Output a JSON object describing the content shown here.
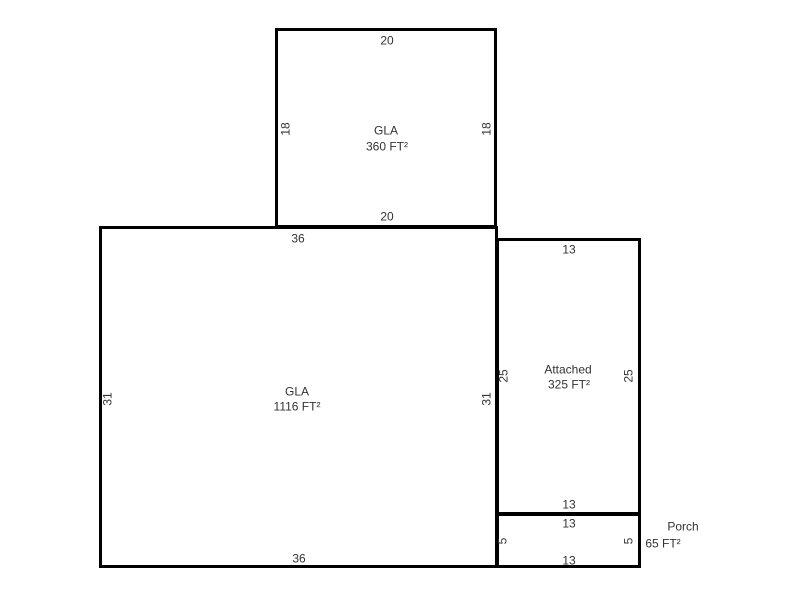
{
  "sketch": {
    "background": "#ffffff",
    "wall_color": "#000000",
    "text_color": "#333333",
    "areas": [
      {
        "id": "gla-upper",
        "name": "GLA",
        "area_text": "360 FT²",
        "rect": {
          "left": 275,
          "top": 28,
          "width": 222,
          "height": 200
        },
        "labels": [
          {
            "role": "name",
            "text": "GLA",
            "x": 386,
            "y": 131
          },
          {
            "role": "area",
            "text": "360 FT²",
            "x": 387,
            "y": 147
          }
        ],
        "dims": [
          {
            "side": "top",
            "text": "20",
            "x": 387,
            "y": 41
          },
          {
            "side": "left",
            "text": "18",
            "x": 286,
            "y": 129
          },
          {
            "side": "right",
            "text": "18",
            "x": 487,
            "y": 129
          },
          {
            "side": "bottom",
            "text": "20",
            "x": 387,
            "y": 217
          }
        ]
      },
      {
        "id": "gla-main",
        "name": "GLA",
        "area_text": "1116 FT²",
        "rect": {
          "left": 99,
          "top": 226,
          "width": 399,
          "height": 342
        },
        "labels": [
          {
            "role": "name",
            "text": "GLA",
            "x": 297,
            "y": 392
          },
          {
            "role": "area",
            "text": "1116 FT²",
            "x": 297,
            "y": 407
          }
        ],
        "dims": [
          {
            "side": "top",
            "text": "36",
            "x": 298,
            "y": 239
          },
          {
            "side": "left",
            "text": "31",
            "x": 108,
            "y": 399
          },
          {
            "side": "right",
            "text": "31",
            "x": 487,
            "y": 399
          },
          {
            "side": "bottom",
            "text": "36",
            "x": 299,
            "y": 559
          }
        ]
      },
      {
        "id": "attached",
        "name": "Attached",
        "area_text": "325 FT²",
        "rect": {
          "left": 496,
          "top": 238,
          "width": 145,
          "height": 277
        },
        "labels": [
          {
            "role": "name",
            "text": "Attached",
            "x": 568,
            "y": 370
          },
          {
            "role": "area",
            "text": "325 FT²",
            "x": 569,
            "y": 385
          }
        ],
        "dims": [
          {
            "side": "top",
            "text": "13",
            "x": 569,
            "y": 250
          },
          {
            "side": "left",
            "text": "25",
            "x": 504,
            "y": 376
          },
          {
            "side": "right",
            "text": "25",
            "x": 629,
            "y": 376
          },
          {
            "side": "bottom",
            "text": "13",
            "x": 569,
            "y": 505
          }
        ]
      },
      {
        "id": "porch",
        "name": "Porch",
        "area_text": "65 FT²",
        "rect": {
          "left": 496,
          "top": 513,
          "width": 145,
          "height": 55
        },
        "labels": [
          {
            "role": "name",
            "text": "Porch",
            "x": 683,
            "y": 527
          },
          {
            "role": "area",
            "text": "65 FT²",
            "x": 663,
            "y": 544
          }
        ],
        "dims": [
          {
            "side": "top",
            "text": "13",
            "x": 569,
            "y": 524
          },
          {
            "side": "left",
            "text": "5",
            "x": 503,
            "y": 541
          },
          {
            "side": "right",
            "text": "5",
            "x": 629,
            "y": 541
          },
          {
            "side": "bottom",
            "text": "13",
            "x": 569,
            "y": 561
          }
        ]
      }
    ]
  }
}
